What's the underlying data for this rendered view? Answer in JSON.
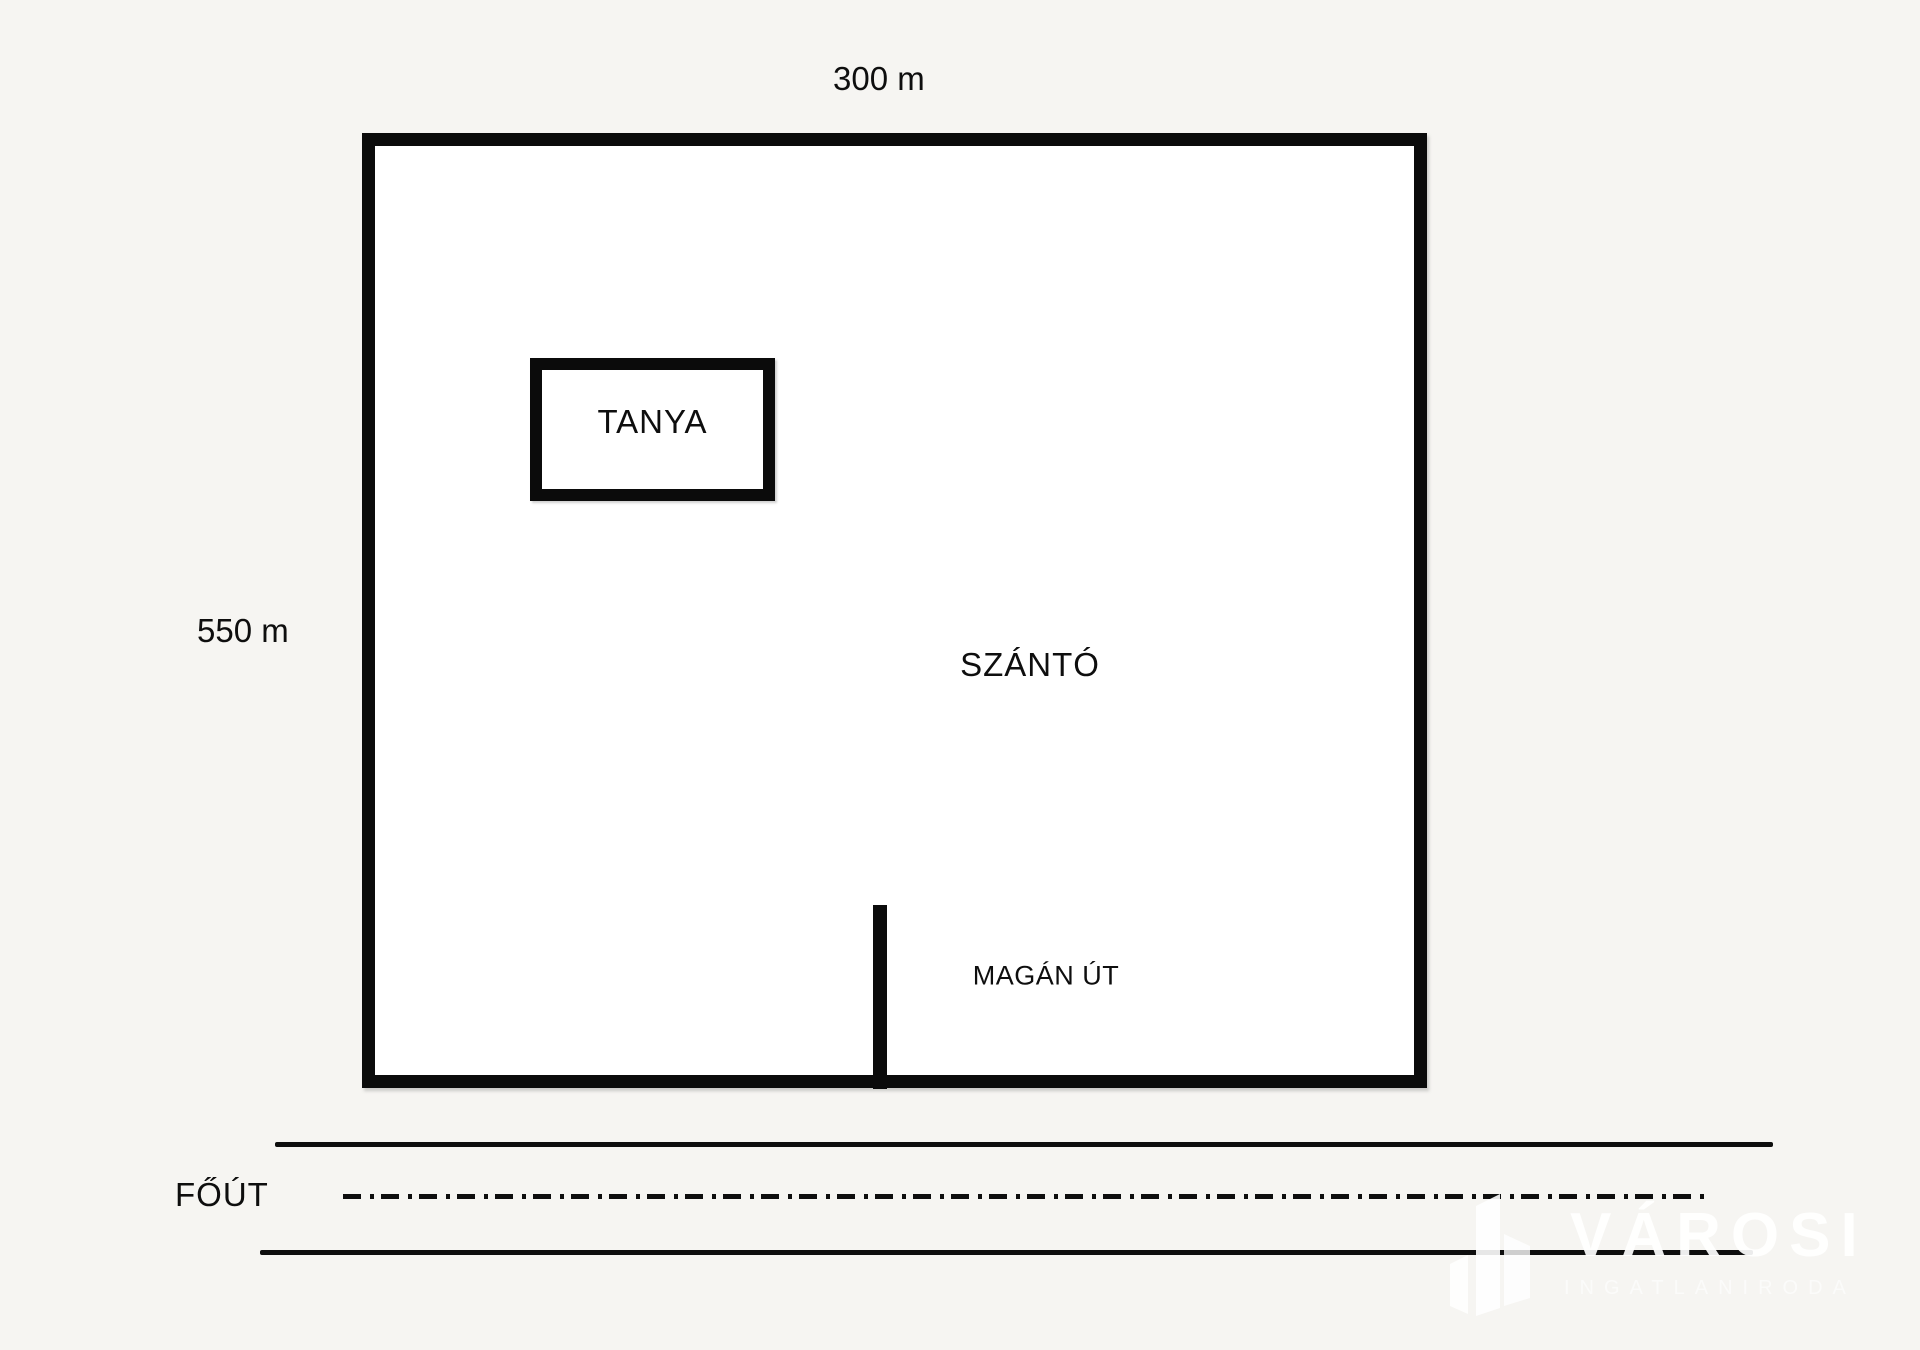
{
  "page": {
    "background_color": "#f6f5f2",
    "ink_color": "#0e0e0e",
    "watermark_color": "#ffffff"
  },
  "plot": {
    "width_label": "300 m",
    "height_label": "550 m",
    "farm_label": "TANYA",
    "field_label": "SZÁNTÓ",
    "private_road_label": "MAGÁN ÚT",
    "main_road_label": "FŐÚT"
  },
  "watermark": {
    "brand": "VÁROSI",
    "tagline": "INGATLANIRODA",
    "logo_icon": "buildings-icon"
  }
}
